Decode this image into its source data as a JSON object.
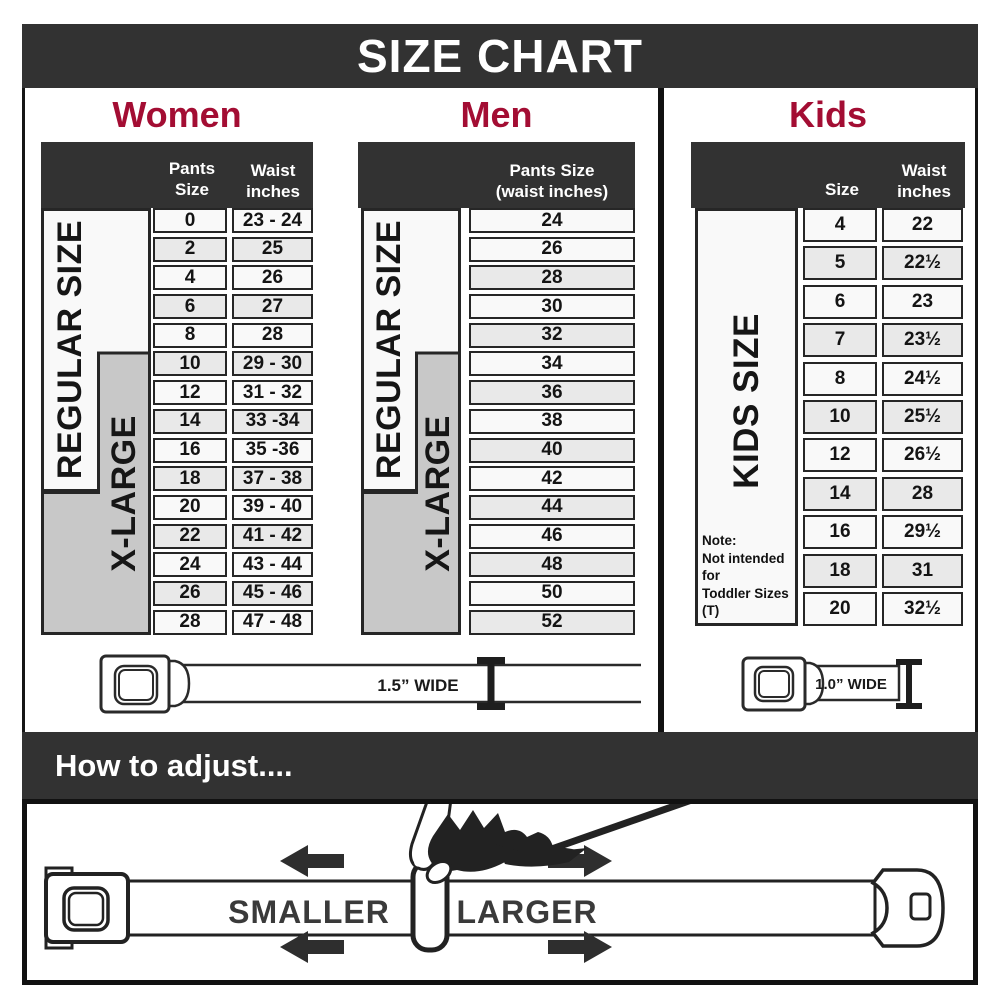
{
  "title": "SIZE CHART",
  "colors": {
    "accent": "#a30d33",
    "header_band": "#323232",
    "gray_box": "#c8c8c8",
    "row_stripe": "#e9e9e9",
    "arrow": "#2e2e2e"
  },
  "sections": {
    "women": {
      "heading": "Women",
      "col1_header": "Pants Size",
      "col2_header_line1": "Waist",
      "col2_header_line2": "inches",
      "regular_label": "REGULAR SIZE",
      "xlarge_label": "X-LARGE",
      "rows": [
        [
          "0",
          "23 - 24"
        ],
        [
          "2",
          "25"
        ],
        [
          "4",
          "26"
        ],
        [
          "6",
          "27"
        ],
        [
          "8",
          "28"
        ],
        [
          "10",
          "29 - 30"
        ],
        [
          "12",
          "31 - 32"
        ],
        [
          "14",
          "33 -34"
        ],
        [
          "16",
          "35 -36"
        ],
        [
          "18",
          "37 - 38"
        ],
        [
          "20",
          "39 - 40"
        ],
        [
          "22",
          "41 - 42"
        ],
        [
          "24",
          "43 - 44"
        ],
        [
          "26",
          "45 - 46"
        ],
        [
          "28",
          "47 - 48"
        ]
      ]
    },
    "men": {
      "heading": "Men",
      "col1_header_line1": "Pants Size",
      "col1_header_line2": "(waist inches)",
      "regular_label": "REGULAR SIZE",
      "xlarge_label": "X-LARGE",
      "rows": [
        "24",
        "26",
        "28",
        "30",
        "32",
        "34",
        "36",
        "38",
        "40",
        "42",
        "44",
        "46",
        "48",
        "50",
        "52"
      ]
    },
    "kids": {
      "heading": "Kids",
      "col1_header": "Size",
      "col2_header_line1": "Waist",
      "col2_header_line2": "inches",
      "side_label": "KIDS SIZE",
      "note_line1": "Note:",
      "note_line2": "Not intended for",
      "note_line3": "Toddler Sizes (T)",
      "rows": [
        [
          "4",
          "22"
        ],
        [
          "5",
          "22½"
        ],
        [
          "6",
          "23"
        ],
        [
          "7",
          "23½"
        ],
        [
          "8",
          "24½"
        ],
        [
          "10",
          "25½"
        ],
        [
          "12",
          "26½"
        ],
        [
          "14",
          "28"
        ],
        [
          "16",
          "29½"
        ],
        [
          "18",
          "31"
        ],
        [
          "20",
          "32½"
        ]
      ]
    }
  },
  "belts": {
    "adult_width_label": "1.5” WIDE",
    "kids_width_label": "1.0” WIDE"
  },
  "adjust": {
    "heading": "How to adjust....",
    "smaller": "SMALLER",
    "larger": "LARGER"
  }
}
